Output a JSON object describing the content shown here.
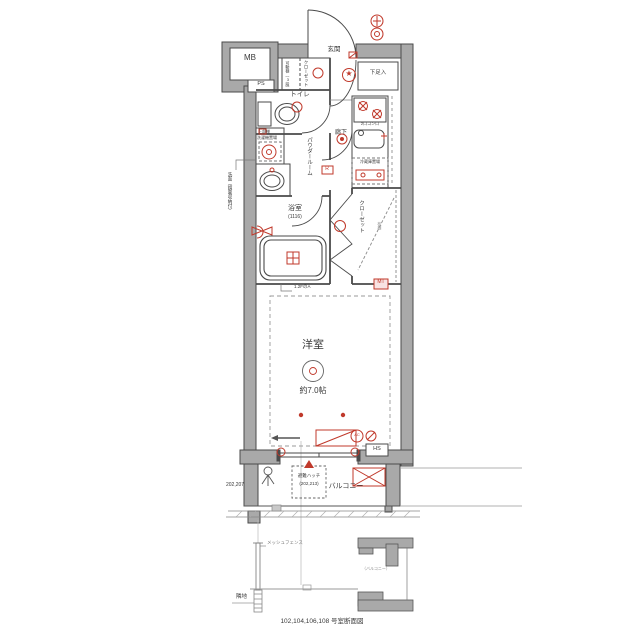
{
  "colors": {
    "wall": "#a9a9a9",
    "line": "#4a4a4a",
    "red": "#c0392b"
  },
  "plan": {
    "meter_box": "MB",
    "pipe_space": "PS",
    "entrance": "玄関",
    "shoe_box": "下足入",
    "entrance_closet": {
      "label": "クローゼット",
      "shelf_note": "可動棚（3段）"
    },
    "toilet": "トイレ",
    "powder_room": "パウダールーム",
    "laundry": {
      "upper_shelf": "上部棚",
      "washer": "洗濯機置場"
    },
    "washbasin_note": "洗面（鏡裏収納付）",
    "corridor": "廊下",
    "kitchen": {
      "stove_note": "2口コンロ",
      "fridge": "冷蔵庫置場"
    },
    "bathroom": {
      "label": "浴室",
      "size": "(1116)"
    },
    "closet": {
      "label": "クローゼット",
      "shelf": "枕棚"
    },
    "meter": "MT",
    "western_room": {
      "label": "洋室",
      "size": "約7.0帖",
      "ceiling_note": "1.2FのA"
    },
    "hs": "HS",
    "ac": "AC",
    "r_mark": "R",
    "balcony": "バルコニー",
    "hatch": {
      "label": "避難ハッチ",
      "numbers": "(202,213)"
    },
    "left_numbers": "202,207"
  },
  "section": {
    "fence": "メッシュフェンス",
    "ground": "隣地",
    "balcony_note": "（バルコニー）",
    "caption": "102,104,106,108 号室断面図"
  },
  "icons": {
    "star": "★"
  }
}
